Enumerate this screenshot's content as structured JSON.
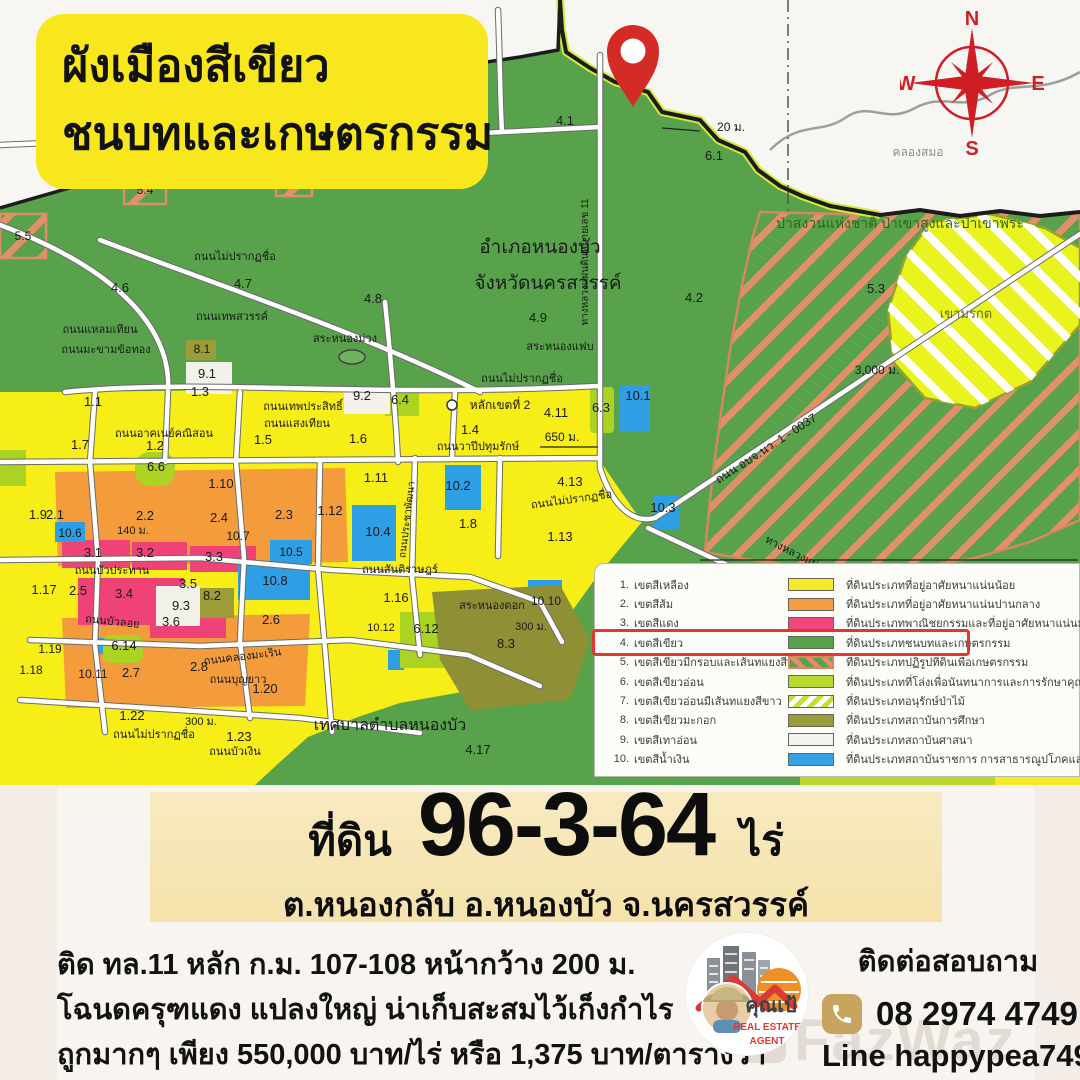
{
  "banner": {
    "line1": "ผังเมืองสีเขียว",
    "line2": "ชนบทและเกษตรกรรม"
  },
  "compass": {
    "n": "N",
    "e": "E",
    "s": "S",
    "w": "W"
  },
  "legend": {
    "items": [
      {
        "no": "1.",
        "name": "เขตสีเหลือง",
        "desc": "ที่ดินประเภทที่อยู่อาศัยหนาแน่นน้อย"
      },
      {
        "no": "2.",
        "name": "เขตสีส้ม",
        "desc": "ที่ดินประเภทที่อยู่อาศัยหนาแน่นปานกลาง"
      },
      {
        "no": "3.",
        "name": "เขตสีแดง",
        "desc": "ที่ดินประเภทพาณิชยกรรมและที่อยู่อาศัยหนาแน่นมาก"
      },
      {
        "no": "4.",
        "name": "เขตสีเขียว",
        "desc": "ที่ดินประเภทชนบทและเกษตรกรรม"
      },
      {
        "no": "5.",
        "name": "เขตสีเขียวมีกรอบและเส้นทแยงสีน้ำตาล",
        "desc": "ที่ดินประเภทปฏิรูปที่ดินเพื่อเกษตรกรรม"
      },
      {
        "no": "6.",
        "name": "เขตสีเขียวอ่อน",
        "desc": "ที่ดินประเภทที่โล่งเพื่อนันทนาการและการรักษาคุณภาพสิ่งแวดล้อม"
      },
      {
        "no": "7.",
        "name": "เขตสีเขียวอ่อนมีเส้นทแยงสีขาว",
        "desc": "ที่ดินประเภทอนุรักษ์ป่าไม้"
      },
      {
        "no": "8.",
        "name": "เขตสีเขียวมะกอก",
        "desc": "ที่ดินประเภทสถาบันการศึกษา"
      },
      {
        "no": "9.",
        "name": "เขตสีเทาอ่อน",
        "desc": "ที่ดินประเภทสถาบันศาสนา"
      },
      {
        "no": "10.",
        "name": "เขตสีน้ำเงิน",
        "desc": "ที่ดินประเภทสถาบันราชการ การสาธารณูปโภคและสาธารณูปการ"
      }
    ]
  },
  "details": {
    "prefix": "ที่ดิน",
    "area": "96-3-64",
    "unit": "ไร่",
    "location": "ต.หนองกลับ อ.หนองบัว จ.นครสวรรค์"
  },
  "description": {
    "line1": "ติด ทล.11 หลัก ก.ม. 107-108 หน้ากว้าง 200 ม.",
    "line2": "โฉนดครุฑแดง แปลงใหญ่ น่าเก็บสะสมไว้เก็งกำไร",
    "line3": "ถูกมากๆ เพียง 550,000 บาท/ไร่ หรือ 1,375 บาท/ตารางวา"
  },
  "contact": {
    "heading": "ติดต่อสอบถาม",
    "phone": "08 2974 4749",
    "line": "Line happypea749"
  },
  "logo": {
    "name": "คุณเป้",
    "line1": "REAL ESTATE",
    "line2": "AGENT"
  },
  "watermark": "FazWaz",
  "map": {
    "labels": [
      {
        "t": "4.1",
        "x": 565,
        "y": 125
      },
      {
        "t": "20 ม.",
        "x": 731,
        "y": 131,
        "s": 12
      },
      {
        "t": "6.1",
        "x": 714,
        "y": 160
      },
      {
        "t": "คลองสมอ",
        "x": 918,
        "y": 156,
        "s": 12,
        "c": "#8a8f94"
      },
      {
        "t": "5.4",
        "x": 145,
        "y": 194,
        "s": 12
      },
      {
        "t": "5.5",
        "x": 23,
        "y": 240,
        "s": 12
      },
      {
        "t": "5.2",
        "x": 294,
        "y": 188,
        "s": 12
      },
      {
        "t": "4.6",
        "x": 120,
        "y": 292
      },
      {
        "t": "4.7",
        "x": 243,
        "y": 288
      },
      {
        "t": "4.8",
        "x": 373,
        "y": 303
      },
      {
        "t": "ถนนไม่ปรากฏชื่อ",
        "x": 235,
        "y": 260,
        "s": 11
      },
      {
        "t": "อำเภอหนองบัว",
        "x": 540,
        "y": 253,
        "s": 19
      },
      {
        "t": "จังหวัดนครสวรรค์",
        "x": 548,
        "y": 289,
        "s": 19
      },
      {
        "t": "4.9",
        "x": 538,
        "y": 322
      },
      {
        "t": "4.2",
        "x": 694,
        "y": 302
      },
      {
        "t": "ป่าสงวนแห่งชาติ ป่าเขาสูงและป่าเขาพระ",
        "x": 900,
        "y": 228,
        "s": 14,
        "c": "#33641f"
      },
      {
        "t": "5.3",
        "x": 876,
        "y": 293
      },
      {
        "t": "เขามรกต",
        "x": 966,
        "y": 318,
        "s": 13,
        "c": "#6b6e1d"
      },
      {
        "t": "3,000 ม.",
        "x": 877,
        "y": 374,
        "s": 12
      },
      {
        "t": "สระหนองม่วง",
        "x": 345,
        "y": 342,
        "s": 11
      },
      {
        "t": "สระหนองแฟบ",
        "x": 560,
        "y": 350,
        "s": 11
      },
      {
        "t": "ถนนเทพสวรรค์",
        "x": 232,
        "y": 320,
        "s": 11
      },
      {
        "t": "ถนนแหลมเทียน",
        "x": 100,
        "y": 333,
        "s": 11
      },
      {
        "t": "ถนนมะขามข้อทอง",
        "x": 106,
        "y": 353,
        "s": 11
      },
      {
        "t": "ถนนไม่ปรากฏชื่อ",
        "x": 522,
        "y": 382,
        "s": 11
      },
      {
        "t": "ทางหลวงแผ่นดินหมายเลข 11",
        "x": 588,
        "y": 262,
        "s": 10,
        "r": -90
      },
      {
        "t": "ถนน อบจ.นว. 1 - 0037",
        "x": 768,
        "y": 452,
        "s": 12,
        "r": -33
      },
      {
        "t": "ทางหลวงแผ่นดิน",
        "x": 800,
        "y": 560,
        "s": 11,
        "r": 27
      },
      {
        "t": "ถนนไม่ปรากฏชื่อ",
        "x": 572,
        "y": 503,
        "s": 11,
        "r": -8
      },
      {
        "t": "4.11",
        "x": 556,
        "y": 417
      },
      {
        "t": "4.13",
        "x": 570,
        "y": 486
      },
      {
        "t": "650 ม.",
        "x": 562,
        "y": 441,
        "s": 12
      },
      {
        "t": "หลักเขตที่ 2",
        "x": 500,
        "y": 409,
        "s": 12
      },
      {
        "t": "6.3",
        "x": 601,
        "y": 412
      },
      {
        "t": "10.1",
        "x": 638,
        "y": 400
      },
      {
        "t": "10.3",
        "x": 663,
        "y": 512
      },
      {
        "t": "1.13",
        "x": 560,
        "y": 541
      },
      {
        "t": "1.1",
        "x": 93,
        "y": 406
      },
      {
        "t": "1.3",
        "x": 200,
        "y": 396
      },
      {
        "t": "1.2",
        "x": 155,
        "y": 450
      },
      {
        "t": "1.7",
        "x": 80,
        "y": 449
      },
      {
        "t": "1.5",
        "x": 263,
        "y": 444
      },
      {
        "t": "1.6",
        "x": 358,
        "y": 443
      },
      {
        "t": "9.2",
        "x": 362,
        "y": 400
      },
      {
        "t": "6.4",
        "x": 400,
        "y": 404
      },
      {
        "t": "8.1",
        "x": 202,
        "y": 353,
        "s": 12
      },
      {
        "t": "9.1",
        "x": 207,
        "y": 378
      },
      {
        "t": "1.4",
        "x": 470,
        "y": 434
      },
      {
        "t": "ถนนอาคเนย์คณิสอน",
        "x": 164,
        "y": 437,
        "s": 11
      },
      {
        "t": "ถนนเทพประสิทธิ์",
        "x": 303,
        "y": 410,
        "s": 11
      },
      {
        "t": "ถนนแสงเทียน",
        "x": 297,
        "y": 427,
        "s": 11
      },
      {
        "t": "ถนนวาปีปทุมรักษ์",
        "x": 478,
        "y": 450,
        "s": 11
      },
      {
        "t": "ถนนประชาพัฒนา",
        "x": 410,
        "y": 520,
        "s": 10,
        "r": -83
      },
      {
        "t": "6.6",
        "x": 156,
        "y": 471
      },
      {
        "t": "1.10",
        "x": 221,
        "y": 488
      },
      {
        "t": "1.11",
        "x": 376,
        "y": 482
      },
      {
        "t": "10.2",
        "x": 458,
        "y": 490
      },
      {
        "t": "1.9",
        "x": 38,
        "y": 519
      },
      {
        "t": "2.1",
        "x": 55,
        "y": 519
      },
      {
        "t": "2.2",
        "x": 145,
        "y": 520
      },
      {
        "t": "2.4",
        "x": 219,
        "y": 522
      },
      {
        "t": "2.3",
        "x": 284,
        "y": 519
      },
      {
        "t": "10.6",
        "x": 70,
        "y": 537,
        "s": 12
      },
      {
        "t": "140 ม.",
        "x": 133,
        "y": 534,
        "s": 11
      },
      {
        "t": "10.7",
        "x": 238,
        "y": 540,
        "s": 12
      },
      {
        "t": "1.12",
        "x": 330,
        "y": 515
      },
      {
        "t": "3.1",
        "x": 93,
        "y": 557
      },
      {
        "t": "3.2",
        "x": 145,
        "y": 557
      },
      {
        "t": "3.3",
        "x": 214,
        "y": 561
      },
      {
        "t": "10.5",
        "x": 291,
        "y": 556,
        "s": 12
      },
      {
        "t": "10.4",
        "x": 378,
        "y": 536
      },
      {
        "t": "1.8",
        "x": 468,
        "y": 528
      },
      {
        "t": "ถนนบัวประทาน",
        "x": 112,
        "y": 574,
        "s": 11
      },
      {
        "t": "ถนนสันติราษฎร์",
        "x": 400,
        "y": 573,
        "s": 11
      },
      {
        "t": "3.5",
        "x": 188,
        "y": 588
      },
      {
        "t": "8.2",
        "x": 212,
        "y": 600
      },
      {
        "t": "10.8",
        "x": 275,
        "y": 585
      },
      {
        "t": "3.4",
        "x": 124,
        "y": 598
      },
      {
        "t": "9.3",
        "x": 181,
        "y": 610
      },
      {
        "t": "1.17",
        "x": 44,
        "y": 594
      },
      {
        "t": "2.5",
        "x": 78,
        "y": 595
      },
      {
        "t": "1.16",
        "x": 396,
        "y": 602
      },
      {
        "t": "สระหนองดอก",
        "x": 492,
        "y": 609,
        "s": 11
      },
      {
        "t": "10.10",
        "x": 546,
        "y": 605,
        "s": 12
      },
      {
        "t": "ถนนบัวลอย",
        "x": 112,
        "y": 625,
        "s": 11,
        "r": 6
      },
      {
        "t": "3.6",
        "x": 171,
        "y": 626
      },
      {
        "t": "2.6",
        "x": 271,
        "y": 624
      },
      {
        "t": "300 ม.",
        "x": 531,
        "y": 630,
        "s": 11
      },
      {
        "t": "8.3",
        "x": 506,
        "y": 648
      },
      {
        "t": "6.12",
        "x": 426,
        "y": 633
      },
      {
        "t": "10.12",
        "x": 381,
        "y": 631,
        "s": 11
      },
      {
        "t": "6.14",
        "x": 124,
        "y": 650
      },
      {
        "t": "1.19",
        "x": 50,
        "y": 653,
        "s": 12
      },
      {
        "t": "ถนนคลองมะเริน",
        "x": 243,
        "y": 660,
        "s": 11,
        "r": -7
      },
      {
        "t": "1.18",
        "x": 31,
        "y": 674,
        "s": 12
      },
      {
        "t": "10.11",
        "x": 93,
        "y": 678,
        "s": 12
      },
      {
        "t": "2.7",
        "x": 131,
        "y": 677
      },
      {
        "t": "2.8",
        "x": 199,
        "y": 671
      },
      {
        "t": "ถนนบุญยาว",
        "x": 238,
        "y": 683,
        "s": 11
      },
      {
        "t": "1.20",
        "x": 265,
        "y": 693
      },
      {
        "t": "ถนนไม่ปรากฏชื่อ",
        "x": 154,
        "y": 738,
        "s": 11
      },
      {
        "t": "1.22",
        "x": 132,
        "y": 720
      },
      {
        "t": "300 ม.",
        "x": 201,
        "y": 725,
        "s": 11
      },
      {
        "t": "1.23",
        "x": 239,
        "y": 741
      },
      {
        "t": "ถนนบัวเงิน",
        "x": 235,
        "y": 755,
        "s": 11
      },
      {
        "t": "เทศบาลตำบลหนองบัว",
        "x": 390,
        "y": 730,
        "s": 16
      },
      {
        "t": "4.17",
        "x": 478,
        "y": 754
      }
    ]
  }
}
